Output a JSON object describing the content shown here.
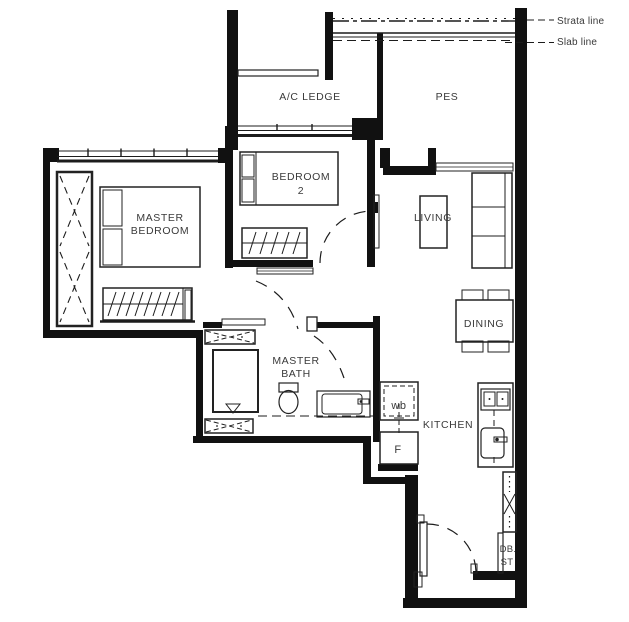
{
  "annotations": {
    "strata": "Strata line",
    "slab": "Slab line"
  },
  "rooms": {
    "ac_ledge": {
      "label": "A/C LEDGE"
    },
    "pes": {
      "label": "PES"
    },
    "master_bedroom": {
      "line1": "MASTER",
      "line2": "BEDROOM"
    },
    "bedroom2": {
      "line1": "BEDROOM",
      "line2": "2"
    },
    "living": {
      "label": "LIVING"
    },
    "dining": {
      "label": "DINING"
    },
    "master_bath": {
      "line1": "MASTER",
      "line2": "BATH"
    },
    "kitchen": {
      "label": "KITCHEN"
    },
    "db_st": {
      "line1": "DB.",
      "line2": "ST"
    }
  },
  "appliances": {
    "washer": "wb",
    "fridge": "F"
  },
  "colors": {
    "wall": "#111111",
    "line": "#222222",
    "text": "#3a3a3a",
    "background": "#ffffff"
  }
}
